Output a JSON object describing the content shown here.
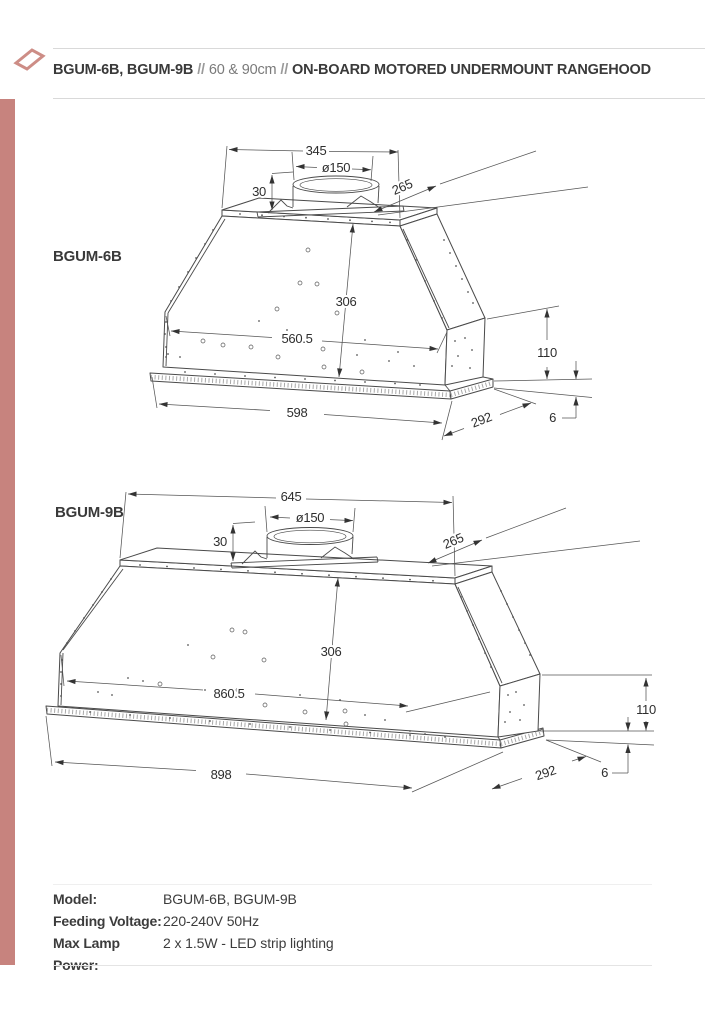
{
  "page": {
    "accent_color": "#c7837e"
  },
  "header": {
    "models": "BGUM-6B, BGUM-9B",
    "separator": "//",
    "size": "60 & 90cm",
    "product": "ON-BOARD MOTORED UNDERMOUNT RANGEHOOD"
  },
  "drawings": [
    {
      "label": "BGUM-6B",
      "dims": {
        "top_width": "345",
        "duct_diameter": "ø150",
        "duct_height": "30",
        "top_depth": "265",
        "body_height": "306",
        "inner_width": "560.5",
        "side_height": "110",
        "total_width": "598",
        "base_depth": "292",
        "base_thickness": "6"
      }
    },
    {
      "label": "BGUM-9B",
      "dims": {
        "top_width": "645",
        "duct_diameter": "ø150",
        "duct_height": "30",
        "top_depth": "265",
        "body_height": "306",
        "inner_width": "860.5",
        "side_height": "110",
        "total_width": "898",
        "base_depth": "292",
        "base_thickness": "6"
      }
    }
  ],
  "specs": {
    "rows": [
      {
        "label": "Model:",
        "value": "BGUM-6B, BGUM-9B"
      },
      {
        "label": "Feeding Voltage:",
        "value": "220-240V 50Hz"
      },
      {
        "label": "Max Lamp Power:",
        "value": "2 x 1.5W - LED strip lighting"
      }
    ]
  }
}
